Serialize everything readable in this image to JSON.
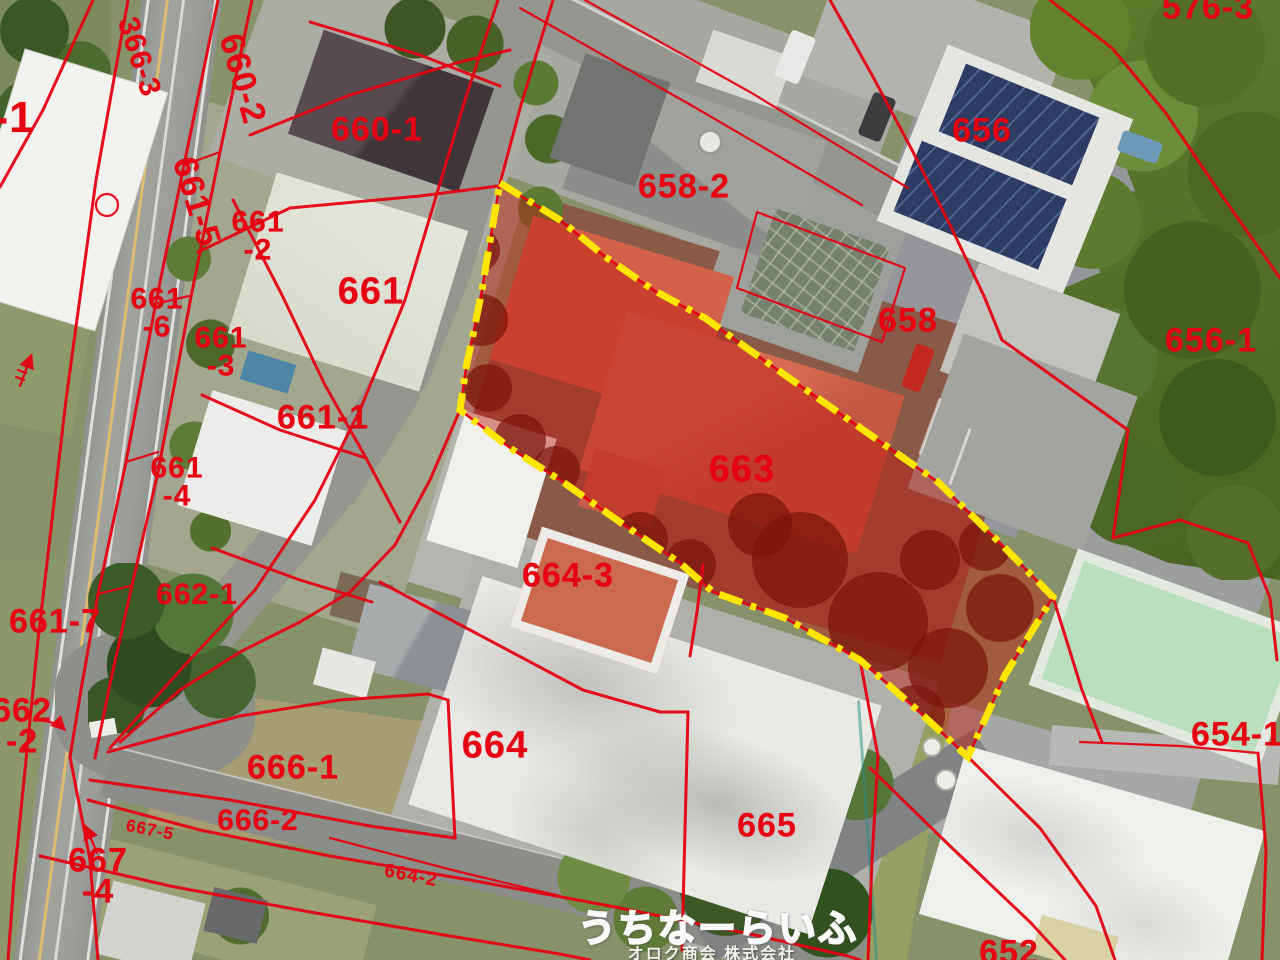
{
  "map_title": "aerial-cadastral-parcel-map",
  "watermark": {
    "brand": "うちなーらいふ",
    "company": "オロク商会 株式会社"
  },
  "colors": {
    "cadastral_line": "#e60012",
    "parcel_label": "#e60012",
    "highlight_border": "#ffe600",
    "highlight_fill": "rgba(190,25,15,0.45)"
  },
  "highlighted_parcel": "663",
  "parcels": [
    {
      "lines": [
        "-1"
      ],
      "x": 14,
      "y": 118,
      "rot": 0,
      "size": 44
    },
    {
      "lines": [
        "366-3"
      ],
      "x": 139,
      "y": 57,
      "rot": 72,
      "size": 30
    },
    {
      "lines": [
        "660-2"
      ],
      "x": 242,
      "y": 79,
      "rot": 74,
      "size": 34
    },
    {
      "lines": [
        "660-1"
      ],
      "x": 377,
      "y": 130,
      "rot": 0,
      "size": 34
    },
    {
      "lines": [
        "661-5"
      ],
      "x": 196,
      "y": 202,
      "rot": 73,
      "size": 34
    },
    {
      "lines": [
        "661",
        "-2"
      ],
      "x": 258,
      "y": 236,
      "rot": 0,
      "size": 30
    },
    {
      "lines": [
        "661"
      ],
      "x": 371,
      "y": 292,
      "rot": 0,
      "size": 38
    },
    {
      "lines": [
        "661",
        "-6"
      ],
      "x": 157,
      "y": 313,
      "rot": 0,
      "size": 30
    },
    {
      "lines": [
        "661",
        "-3"
      ],
      "x": 221,
      "y": 352,
      "rot": 0,
      "size": 30
    },
    {
      "lines": [
        "661-1"
      ],
      "x": 323,
      "y": 418,
      "rot": 0,
      "size": 34
    },
    {
      "lines": [
        "661",
        "-4"
      ],
      "x": 177,
      "y": 482,
      "rot": 0,
      "size": 30
    },
    {
      "lines": [
        "662-1"
      ],
      "x": 197,
      "y": 595,
      "rot": 0,
      "size": 30
    },
    {
      "lines": [
        "661-7"
      ],
      "x": 55,
      "y": 622,
      "rot": 0,
      "size": 34
    },
    {
      "lines": [
        "662",
        "-2"
      ],
      "x": 22,
      "y": 727,
      "rot": 0,
      "size": 34
    },
    {
      "lines": [
        "666-1"
      ],
      "x": 293,
      "y": 768,
      "rot": 0,
      "size": 34
    },
    {
      "lines": [
        "666-2"
      ],
      "x": 258,
      "y": 821,
      "rot": 0,
      "size": 30
    },
    {
      "lines": [
        "667-5"
      ],
      "x": 150,
      "y": 830,
      "rot": 11,
      "size": 17
    },
    {
      "lines": [
        "667",
        "-4"
      ],
      "x": 98,
      "y": 877,
      "rot": 0,
      "size": 34
    },
    {
      "lines": [
        "664-2"
      ],
      "x": 411,
      "y": 876,
      "rot": 11,
      "size": 19
    },
    {
      "lines": [
        "664"
      ],
      "x": 495,
      "y": 746,
      "rot": 0,
      "size": 38
    },
    {
      "lines": [
        "664-3"
      ],
      "x": 568,
      "y": 576,
      "rot": 0,
      "size": 34
    },
    {
      "lines": [
        "665"
      ],
      "x": 767,
      "y": 826,
      "rot": 0,
      "size": 34
    },
    {
      "lines": [
        "663"
      ],
      "x": 742,
      "y": 470,
      "rot": 0,
      "size": 38
    },
    {
      "lines": [
        "658-2"
      ],
      "x": 684,
      "y": 187,
      "rot": 0,
      "size": 34
    },
    {
      "lines": [
        "658"
      ],
      "x": 908,
      "y": 321,
      "rot": 0,
      "size": 34
    },
    {
      "lines": [
        "656"
      ],
      "x": 982,
      "y": 131,
      "rot": 0,
      "size": 34
    },
    {
      "lines": [
        "656-1"
      ],
      "x": 1211,
      "y": 341,
      "rot": 0,
      "size": 34
    },
    {
      "lines": [
        "654-1"
      ],
      "x": 1237,
      "y": 735,
      "rot": 0,
      "size": 34
    },
    {
      "lines": [
        "652"
      ],
      "x": 1009,
      "y": 953,
      "rot": 0,
      "size": 34
    },
    {
      "lines": [
        "576-3"
      ],
      "x": 1208,
      "y": 8,
      "rot": 0,
      "size": 34
    }
  ]
}
